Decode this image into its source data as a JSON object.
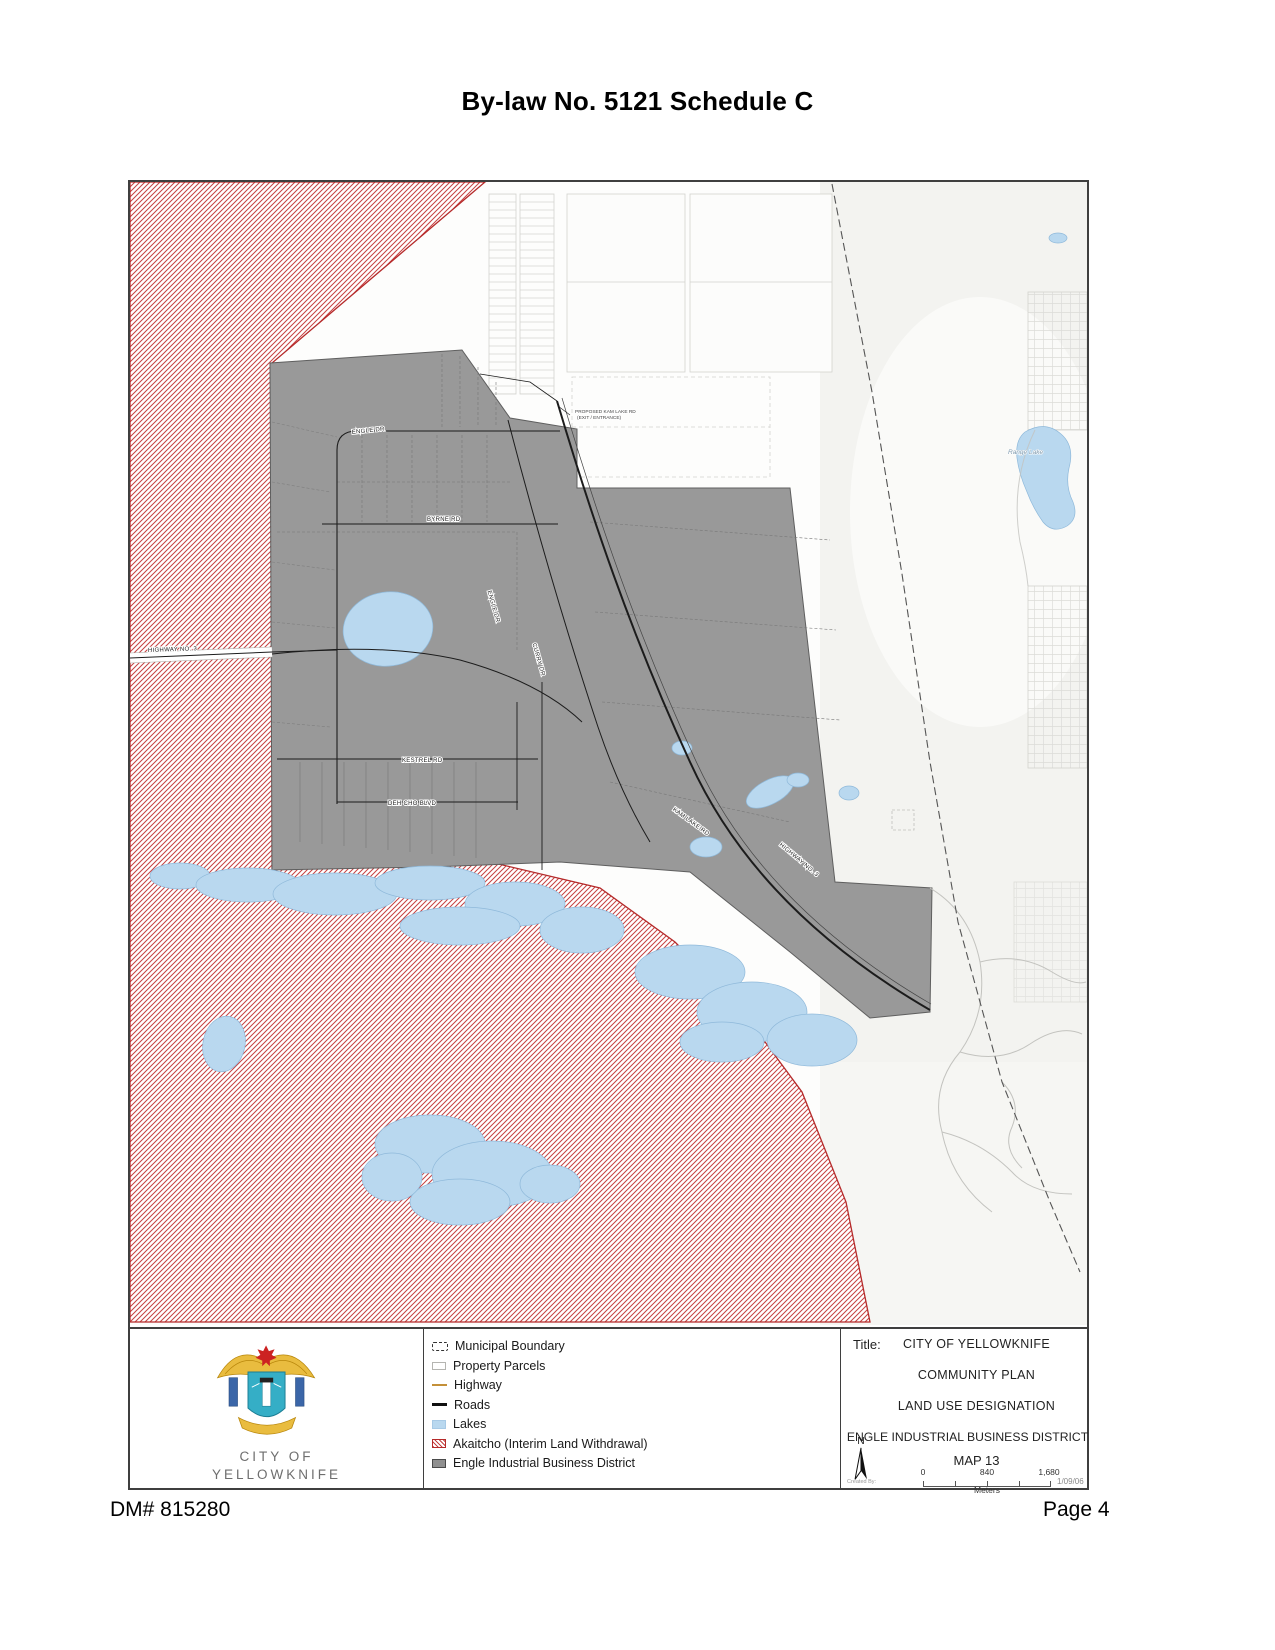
{
  "page": {
    "title": "By-law No. 5121 Schedule C",
    "footer_left": "DM# 815280",
    "footer_right": "Page 4"
  },
  "logo": {
    "line1": "CITY OF",
    "line2": "YELLOWKNIFE"
  },
  "legend": {
    "items": [
      {
        "label": "Municipal Boundary",
        "symbol": "dashed-boundary-line"
      },
      {
        "label": "Property Parcels",
        "symbol": "outlined-box"
      },
      {
        "label": "Highway",
        "symbol": "orange-line"
      },
      {
        "label": "Roads",
        "symbol": "black-line"
      },
      {
        "label": "Lakes",
        "symbol": "blue-fill"
      },
      {
        "label": "Akaitcho (Interim Land Withdrawal)",
        "symbol": "red-hatch"
      },
      {
        "label": "Engle Industrial Business District",
        "symbol": "gray-fill"
      }
    ]
  },
  "title_block": {
    "label": "Title:",
    "line1": "CITY OF YELLOWKNIFE",
    "line2": "COMMUNITY PLAN",
    "line3": "LAND USE DESIGNATION",
    "line4": "ENGLE INDUSTRIAL BUSINESS DISTRICT",
    "map_no": "MAP 13",
    "north_label": "N",
    "scale_ticks": [
      "0",
      "840",
      "1,680"
    ],
    "scale_unit": "Meters",
    "created_by": "Created By:",
    "date": "1/09/06"
  },
  "map_labels": {
    "engle_dr": "ENGLE DR",
    "byrne_rd": "BYRNE RD",
    "engle_dr_diag": "ENGLE DR",
    "curry_dr": "CURRY DR",
    "highway_west": "HIGHWAY NO. 3",
    "kestrel_rd": "KESTREL RD",
    "deh_cho_blvd": "DEH CHO BLVD",
    "kam_lake_rd": "KAM LAKE RD",
    "highway_diag": "HIGHWAY NO. 3",
    "range_lake": "Range Lake",
    "callout_line1": "PROPOSED KAM LAKE RD",
    "callout_line2": "(EXIT / ENTRANCE)"
  },
  "colors": {
    "akaitcho_red": "#c64040",
    "akaitcho_border": "#b52a2a",
    "district_gray": "#999999",
    "lake_blue": "#b9d8ef",
    "highway_orange": "#c49039",
    "road_black": "#1c1c1c"
  }
}
